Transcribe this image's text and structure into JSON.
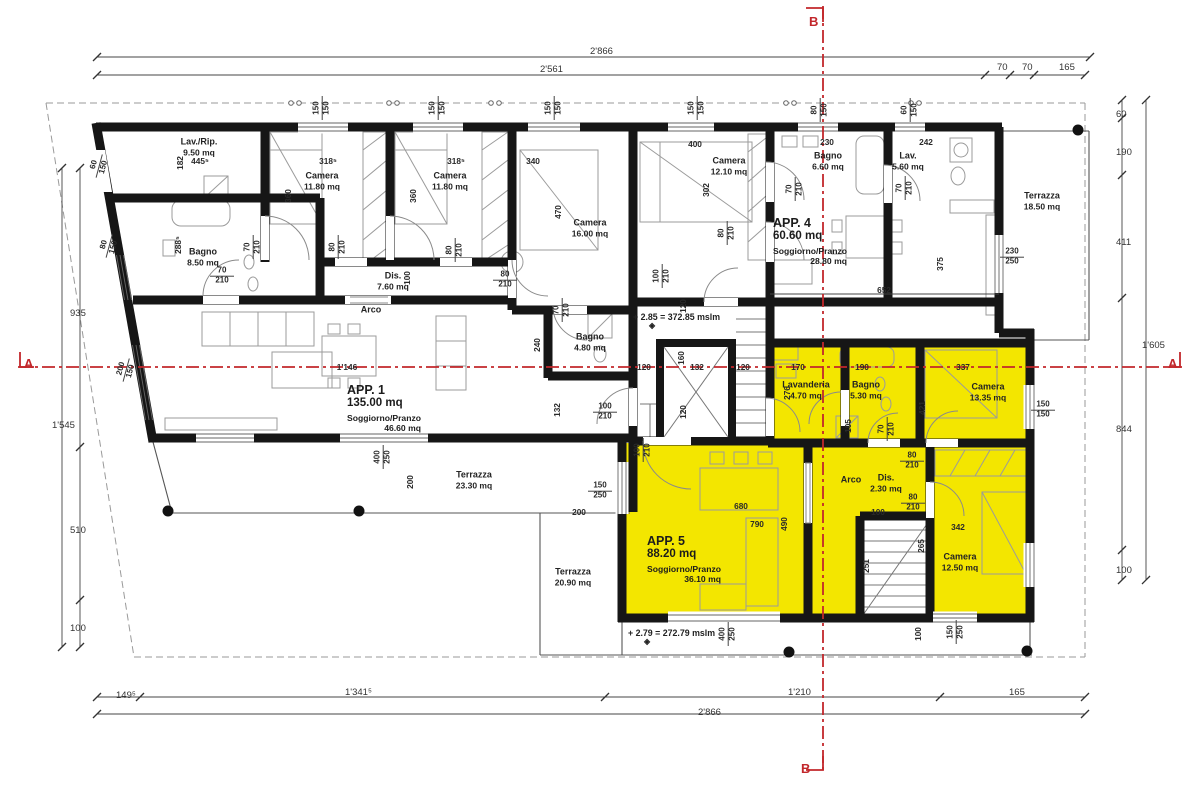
{
  "drawing": {
    "type": "architectural floor plan",
    "highlight_color": "#F3E600",
    "section_line_color": "#C2272B",
    "wall_color": "#161616"
  },
  "section_markers": [
    {
      "label": "A",
      "x": 24,
      "y": 356
    },
    {
      "label": "A",
      "x": 1168,
      "y": 356
    },
    {
      "label": "B",
      "x": 809,
      "y": 14
    },
    {
      "label": "B",
      "x": 801,
      "y": 761
    }
  ],
  "apartments": [
    {
      "name": "APP. 1",
      "area": "135.00 mq",
      "sub": "Soggiorno/Pranzo",
      "sub_area": "46.60 mq",
      "x": 347,
      "y": 383
    },
    {
      "name": "APP. 4",
      "area": "60.60 mq",
      "sub": "Soggiorno/Pranzo",
      "sub_area": "28.80 mq",
      "x": 773,
      "y": 216
    },
    {
      "name": "APP. 5",
      "area": "88.20 mq",
      "sub": "Soggiorno/Pranzo",
      "sub_area": "36.10 mq",
      "x": 647,
      "y": 534
    }
  ],
  "rooms": [
    {
      "n": "Lav./Rip.",
      "a": "9.50 mq",
      "x": 199,
      "y": 147
    },
    {
      "n": "Camera",
      "a": "11.80 mq",
      "x": 322,
      "y": 181
    },
    {
      "n": "Camera",
      "a": "11.80 mq",
      "x": 450,
      "y": 181
    },
    {
      "n": "Camera",
      "a": "16.00 mq",
      "x": 590,
      "y": 228
    },
    {
      "n": "Camera",
      "a": "12.10 mq",
      "x": 729,
      "y": 166
    },
    {
      "n": "Bagno",
      "a": "6.60 mq",
      "x": 828,
      "y": 161
    },
    {
      "n": "Lav.",
      "a": "5.60 mq",
      "x": 908,
      "y": 161
    },
    {
      "n": "Terrazza",
      "a": "18.50 mq",
      "x": 1042,
      "y": 201
    },
    {
      "n": "Bagno",
      "a": "8.50 mq",
      "x": 203,
      "y": 257
    },
    {
      "n": "Dis.",
      "a": "7.60 mq",
      "x": 393,
      "y": 281
    },
    {
      "n": "Arco",
      "a": "",
      "x": 371,
      "y": 310
    },
    {
      "n": "Bagno",
      "a": "4.80 mq",
      "x": 590,
      "y": 342
    },
    {
      "n": "Lavanderia",
      "a": "4.70 mq",
      "x": 806,
      "y": 390
    },
    {
      "n": "Bagno",
      "a": "5.30 mq",
      "x": 866,
      "y": 390
    },
    {
      "n": "Camera",
      "a": "13.35 mq",
      "x": 988,
      "y": 392
    },
    {
      "n": "Arco",
      "a": "",
      "x": 851,
      "y": 480
    },
    {
      "n": "Dis.",
      "a": "2.30 mq",
      "x": 886,
      "y": 483
    },
    {
      "n": "Camera",
      "a": "12.50 mq",
      "x": 960,
      "y": 562
    },
    {
      "n": "Terrazza",
      "a": "23.30 mq",
      "x": 474,
      "y": 480
    },
    {
      "n": "Terrazza",
      "a": "20.90 mq",
      "x": 573,
      "y": 577
    }
  ],
  "levels": [
    {
      "t": "+ 2.85 = 372.85 mslm",
      "x": 633,
      "y": 312
    },
    {
      "t": "+ 2.79 = 272.79 mslm",
      "x": 628,
      "y": 628
    }
  ],
  "dims_boundary": [
    {
      "t": "2'866",
      "x": 590,
      "y": 46,
      "r": 0
    },
    {
      "t": "2'561",
      "x": 540,
      "y": 64,
      "r": 0
    },
    {
      "t": "70",
      "x": 997,
      "y": 62,
      "r": 0
    },
    {
      "t": "70",
      "x": 1022,
      "y": 62,
      "r": 0
    },
    {
      "t": "165",
      "x": 1059,
      "y": 62,
      "r": 0
    },
    {
      "t": "149⁵",
      "x": 116,
      "y": 690,
      "r": 0
    },
    {
      "t": "1'341⁵",
      "x": 345,
      "y": 687,
      "r": 0
    },
    {
      "t": "1'210",
      "x": 788,
      "y": 687,
      "r": 0
    },
    {
      "t": "165",
      "x": 1009,
      "y": 687,
      "r": 0
    },
    {
      "t": "2'866",
      "x": 698,
      "y": 707,
      "r": 0
    },
    {
      "t": "935",
      "x": 70,
      "y": 308,
      "r": -90
    },
    {
      "t": "1'545",
      "x": 52,
      "y": 420,
      "r": -90
    },
    {
      "t": "510",
      "x": 70,
      "y": 525,
      "r": -90
    },
    {
      "t": "100",
      "x": 70,
      "y": 623,
      "r": -90
    },
    {
      "t": "60",
      "x": 1116,
      "y": 109,
      "r": -90
    },
    {
      "t": "190",
      "x": 1116,
      "y": 147,
      "r": -90
    },
    {
      "t": "411",
      "x": 1116,
      "y": 237,
      "r": -90
    },
    {
      "t": "844",
      "x": 1116,
      "y": 424,
      "r": -90
    },
    {
      "t": "100",
      "x": 1116,
      "y": 565,
      "r": -90
    },
    {
      "t": "1'605",
      "x": 1142,
      "y": 340,
      "r": -90
    }
  ],
  "dims_interior": [
    {
      "t": "445⁵",
      "x": 200,
      "y": 161,
      "r": 0
    },
    {
      "t": "182",
      "x": 180,
      "y": 163,
      "r": -90
    },
    {
      "t": "318⁵",
      "x": 328,
      "y": 161,
      "r": 0
    },
    {
      "t": "318⁵",
      "x": 456,
      "y": 161,
      "r": 0
    },
    {
      "t": "340",
      "x": 533,
      "y": 161,
      "r": 0
    },
    {
      "t": "400",
      "x": 695,
      "y": 144,
      "r": 0
    },
    {
      "t": "230",
      "x": 827,
      "y": 142,
      "r": 0
    },
    {
      "t": "242",
      "x": 926,
      "y": 142,
      "r": 0
    },
    {
      "t": "360",
      "x": 288,
      "y": 196,
      "r": -90
    },
    {
      "t": "360",
      "x": 413,
      "y": 196,
      "r": -90
    },
    {
      "t": "470",
      "x": 558,
      "y": 212,
      "r": -90
    },
    {
      "t": "302",
      "x": 706,
      "y": 190,
      "r": -90
    },
    {
      "t": "288⁵",
      "x": 178,
      "y": 245,
      "r": -90
    },
    {
      "t": "100",
      "x": 407,
      "y": 278,
      "r": -90
    },
    {
      "t": "1'146",
      "x": 347,
      "y": 367,
      "r": 0
    },
    {
      "t": "120",
      "x": 644,
      "y": 367,
      "r": 0
    },
    {
      "t": "132",
      "x": 697,
      "y": 367,
      "r": 0
    },
    {
      "t": "120",
      "x": 743,
      "y": 367,
      "r": 0
    },
    {
      "t": "170",
      "x": 798,
      "y": 367,
      "r": 0
    },
    {
      "t": "190",
      "x": 862,
      "y": 367,
      "r": 0
    },
    {
      "t": "337",
      "x": 963,
      "y": 367,
      "r": 0
    },
    {
      "t": "375",
      "x": 940,
      "y": 264,
      "r": -90
    },
    {
      "t": "652",
      "x": 884,
      "y": 290,
      "r": 0
    },
    {
      "t": "240",
      "x": 537,
      "y": 345,
      "r": -90
    },
    {
      "t": "132",
      "x": 557,
      "y": 410,
      "r": -90
    },
    {
      "t": "120",
      "x": 683,
      "y": 306,
      "r": -90
    },
    {
      "t": "160",
      "x": 681,
      "y": 358,
      "r": -90
    },
    {
      "t": "120",
      "x": 683,
      "y": 412,
      "r": -90
    },
    {
      "t": "276",
      "x": 787,
      "y": 393,
      "r": -90
    },
    {
      "t": "105",
      "x": 848,
      "y": 426,
      "r": -90
    },
    {
      "t": "421",
      "x": 922,
      "y": 408,
      "r": -90
    },
    {
      "t": "680",
      "x": 741,
      "y": 506,
      "r": 0
    },
    {
      "t": "790",
      "x": 757,
      "y": 524,
      "r": 0
    },
    {
      "t": "490",
      "x": 784,
      "y": 524,
      "r": -90
    },
    {
      "t": "251",
      "x": 866,
      "y": 566,
      "r": -90
    },
    {
      "t": "265",
      "x": 921,
      "y": 546,
      "r": -90
    },
    {
      "t": "342",
      "x": 958,
      "y": 527,
      "r": 0
    },
    {
      "t": "100",
      "x": 878,
      "y": 512,
      "r": 0
    },
    {
      "t": "200",
      "x": 579,
      "y": 512,
      "r": 0
    },
    {
      "t": "200",
      "x": 410,
      "y": 482,
      "r": -90
    },
    {
      "t": "100",
      "x": 918,
      "y": 634,
      "r": -90
    }
  ],
  "stacked_dims": [
    {
      "a": "150",
      "b": "150",
      "x": 322,
      "y": 108,
      "r": -90
    },
    {
      "a": "150",
      "b": "150",
      "x": 438,
      "y": 108,
      "r": -90
    },
    {
      "a": "150",
      "b": "150",
      "x": 554,
      "y": 108,
      "r": -90
    },
    {
      "a": "150",
      "b": "150",
      "x": 697,
      "y": 108,
      "r": -90
    },
    {
      "a": "80",
      "b": "150",
      "x": 820,
      "y": 110,
      "r": -90
    },
    {
      "a": "60",
      "b": "150",
      "x": 910,
      "y": 110,
      "r": -90
    },
    {
      "a": "60",
      "b": "150",
      "x": 99,
      "y": 166,
      "r": -75
    },
    {
      "a": "80",
      "b": "150",
      "x": 109,
      "y": 246,
      "r": -75
    },
    {
      "a": "200",
      "b": "150",
      "x": 126,
      "y": 370,
      "r": -75
    },
    {
      "a": "70",
      "b": "210",
      "x": 253,
      "y": 247,
      "r": -90
    },
    {
      "a": "80",
      "b": "210",
      "x": 338,
      "y": 247,
      "r": -90
    },
    {
      "a": "80",
      "b": "210",
      "x": 455,
      "y": 250,
      "r": -90
    },
    {
      "a": "70",
      "b": "210",
      "x": 222,
      "y": 276,
      "r": 0
    },
    {
      "a": "80",
      "b": "210",
      "x": 505,
      "y": 280,
      "r": 0
    },
    {
      "a": "70",
      "b": "210",
      "x": 562,
      "y": 310,
      "r": -90
    },
    {
      "a": "100",
      "b": "210",
      "x": 605,
      "y": 412,
      "r": 0
    },
    {
      "a": "100",
      "b": "210",
      "x": 643,
      "y": 450,
      "r": -90
    },
    {
      "a": "100",
      "b": "210",
      "x": 662,
      "y": 276,
      "r": -90
    },
    {
      "a": "80",
      "b": "210",
      "x": 727,
      "y": 233,
      "r": -90
    },
    {
      "a": "70",
      "b": "210",
      "x": 795,
      "y": 189,
      "r": -90
    },
    {
      "a": "70",
      "b": "210",
      "x": 905,
      "y": 188,
      "r": -90
    },
    {
      "a": "70",
      "b": "210",
      "x": 887,
      "y": 429,
      "r": -90
    },
    {
      "a": "80",
      "b": "210",
      "x": 912,
      "y": 461,
      "r": 0
    },
    {
      "a": "80",
      "b": "210",
      "x": 913,
      "y": 503,
      "r": 0
    },
    {
      "a": "230",
      "b": "250",
      "x": 1012,
      "y": 257,
      "r": 0
    },
    {
      "a": "150",
      "b": "150",
      "x": 1043,
      "y": 410,
      "r": 0
    },
    {
      "a": "150",
      "b": "250",
      "x": 600,
      "y": 491,
      "r": 0
    },
    {
      "a": "400",
      "b": "250",
      "x": 383,
      "y": 457,
      "r": -90
    },
    {
      "a": "400",
      "b": "250",
      "x": 728,
      "y": 634,
      "r": -90
    },
    {
      "a": "150",
      "b": "250",
      "x": 956,
      "y": 632,
      "r": -90
    }
  ]
}
